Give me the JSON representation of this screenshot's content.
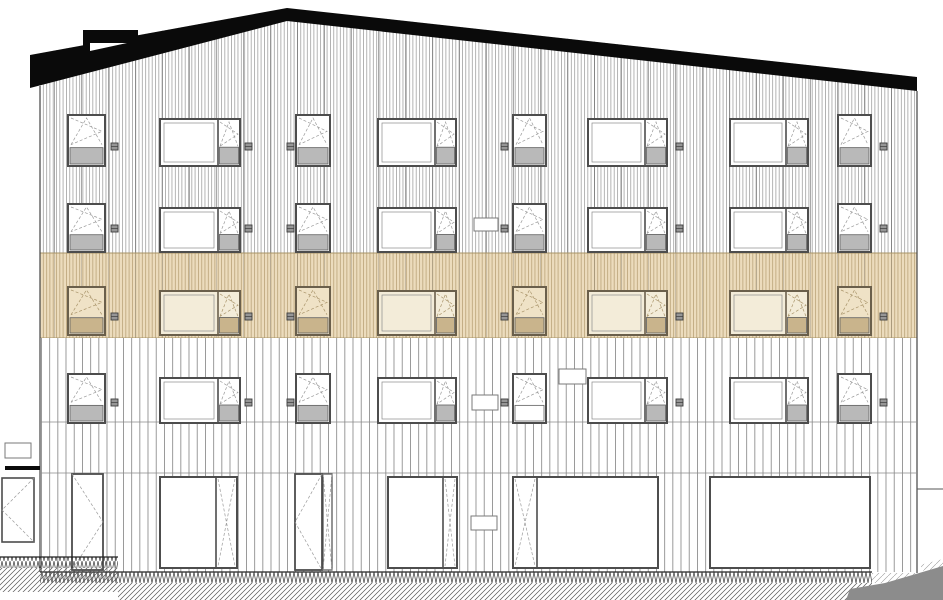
{
  "drawing": {
    "type": "architectural-elevation-facade",
    "canvas": {
      "width": 943,
      "height": 600
    },
    "colors": {
      "roof": "#0a0a0a",
      "siding_dense_line": "#9b9b9b",
      "siding_accent_line": "#606060",
      "siding_wide_line": "#828282",
      "highlight_bg": "#ecdcbd",
      "highlight_line": "#b79f74",
      "highlight_edge": "#a89468",
      "frame": "#4d4d4d",
      "frame_highlight": "#6a5f4b",
      "glass": "#ffffff",
      "glass_highlight": "#efe2c6",
      "glass_fixed_highlight": "#f3ecd9",
      "sill": "#b9b9b9",
      "sill_border": "#5f5f5f",
      "sill_highlight": "#c9b48c",
      "symbol": "#9a9a9a",
      "symbol_highlight": "#a9946a",
      "vent_fill": "#969696",
      "vent_border": "#3c3c3c",
      "sign_border": "#7a7a7a",
      "ground_hatch": "#555555",
      "ground_hatch_light": "#999999",
      "terrain": "#8c8c8c",
      "edge_line": "#444444",
      "floor_line": "#8a8a8a"
    },
    "facade": {
      "left": 40,
      "right": 917,
      "bottom": 572,
      "dense_top": 18,
      "band_top": 253,
      "band_bottom": 338,
      "row4_line_y": 422,
      "storefront_line_y": 473
    },
    "roof": {
      "sky_poly": "0,0 943,0 943,77 917,77 287,8 30,55 0,55",
      "roof_poly": "30,55 287,8 917,77 917,91 287,21 30,88",
      "chimney_bar": [
        83,
        30,
        55,
        13
      ],
      "chimney_stem": [
        83,
        30,
        7,
        27
      ],
      "chimney_notch": "90,43 127,43 90,51"
    },
    "window_rows": [
      {
        "name": "floor-4",
        "y": 115,
        "h": 51,
        "style": "default",
        "vent_y": 143
      },
      {
        "name": "floor-3",
        "y": 204,
        "h": 48,
        "style": "default",
        "vent_y": 225
      },
      {
        "name": "floor-2",
        "y": 287,
        "h": 48,
        "style": "highlight",
        "vent_y": 313
      },
      {
        "name": "floor-1",
        "y": 374,
        "h": 49,
        "style": "default",
        "vent_y": 399
      }
    ],
    "window_columns": [
      {
        "type": "square",
        "x": 68,
        "w": 37,
        "open_w": 0
      },
      {
        "type": "wide",
        "x": 160,
        "w": 80,
        "open_w": 22
      },
      {
        "type": "square",
        "x": 296,
        "w": 34,
        "open_w": 0
      },
      {
        "type": "wide",
        "x": 378,
        "w": 78,
        "open_w": 21
      },
      {
        "type": "square",
        "x": 513,
        "w": 33,
        "open_w": 0
      },
      {
        "type": "wide",
        "x": 588,
        "w": 79,
        "open_w": 22
      },
      {
        "type": "wide",
        "x": 730,
        "w": 78,
        "open_w": 22
      },
      {
        "type": "square",
        "x": 838,
        "w": 33,
        "open_w": 0
      }
    ],
    "white_sill_exception": {
      "row": 3,
      "col": 4
    },
    "vents": {
      "xs": [
        111,
        245,
        287,
        501,
        676,
        880
      ],
      "size": 7
    },
    "signs": [
      {
        "x": 5,
        "y": 443,
        "w": 26,
        "h": 15,
        "location": "outside-left"
      },
      {
        "x": 474,
        "y": 218,
        "w": 24,
        "h": 13,
        "location": "floor-3"
      },
      {
        "x": 559,
        "y": 369,
        "w": 27,
        "h": 15,
        "location": "floor-1-upper"
      },
      {
        "x": 472,
        "y": 395,
        "w": 26,
        "h": 15,
        "location": "floor-1"
      },
      {
        "x": 471,
        "y": 516,
        "w": 26,
        "h": 14,
        "location": "ground"
      }
    ],
    "ground_floor": {
      "door_top": 474,
      "door_bottom": 570,
      "sf_top": 477,
      "sf_bottom": 568,
      "units": [
        {
          "kind": "door",
          "x": 72,
          "w": 31,
          "swing": "right",
          "panel_w": 0
        },
        {
          "kind": "storefront",
          "x": 160,
          "w": 77,
          "open_side": "right",
          "open_w": 21
        },
        {
          "kind": "door",
          "x": 295,
          "w": 27,
          "swing": "left",
          "panel_w": 9
        },
        {
          "kind": "storefront",
          "x": 388,
          "w": 69,
          "open_side": "right",
          "open_w": 14
        },
        {
          "kind": "storefront",
          "x": 513,
          "w": 145,
          "open_side": "left",
          "open_w": 24
        },
        {
          "kind": "storefront",
          "x": 710,
          "w": 160,
          "open_side": "none",
          "open_w": 0
        }
      ]
    },
    "side_entrance": {
      "door": [
        2,
        478,
        32,
        64
      ],
      "canopy": [
        5,
        466,
        35,
        4
      ]
    },
    "ground": {
      "main_zig": [
        40,
        572,
        832,
        11
      ],
      "main_hatch": [
        118,
        583,
        754,
        17
      ],
      "left_zig": [
        0,
        557,
        118,
        11
      ],
      "left_hatch": [
        0,
        568,
        118,
        24
      ],
      "right_light_hatch": [
        872,
        573,
        48,
        10
      ],
      "right_small_hatch_poly": "920,565 943,559 943,571 926,575",
      "terrain_poly": "846,600 850,589 885,583 943,566 943,600",
      "fence_line": [
        917,
        489,
        943,
        489
      ]
    }
  }
}
